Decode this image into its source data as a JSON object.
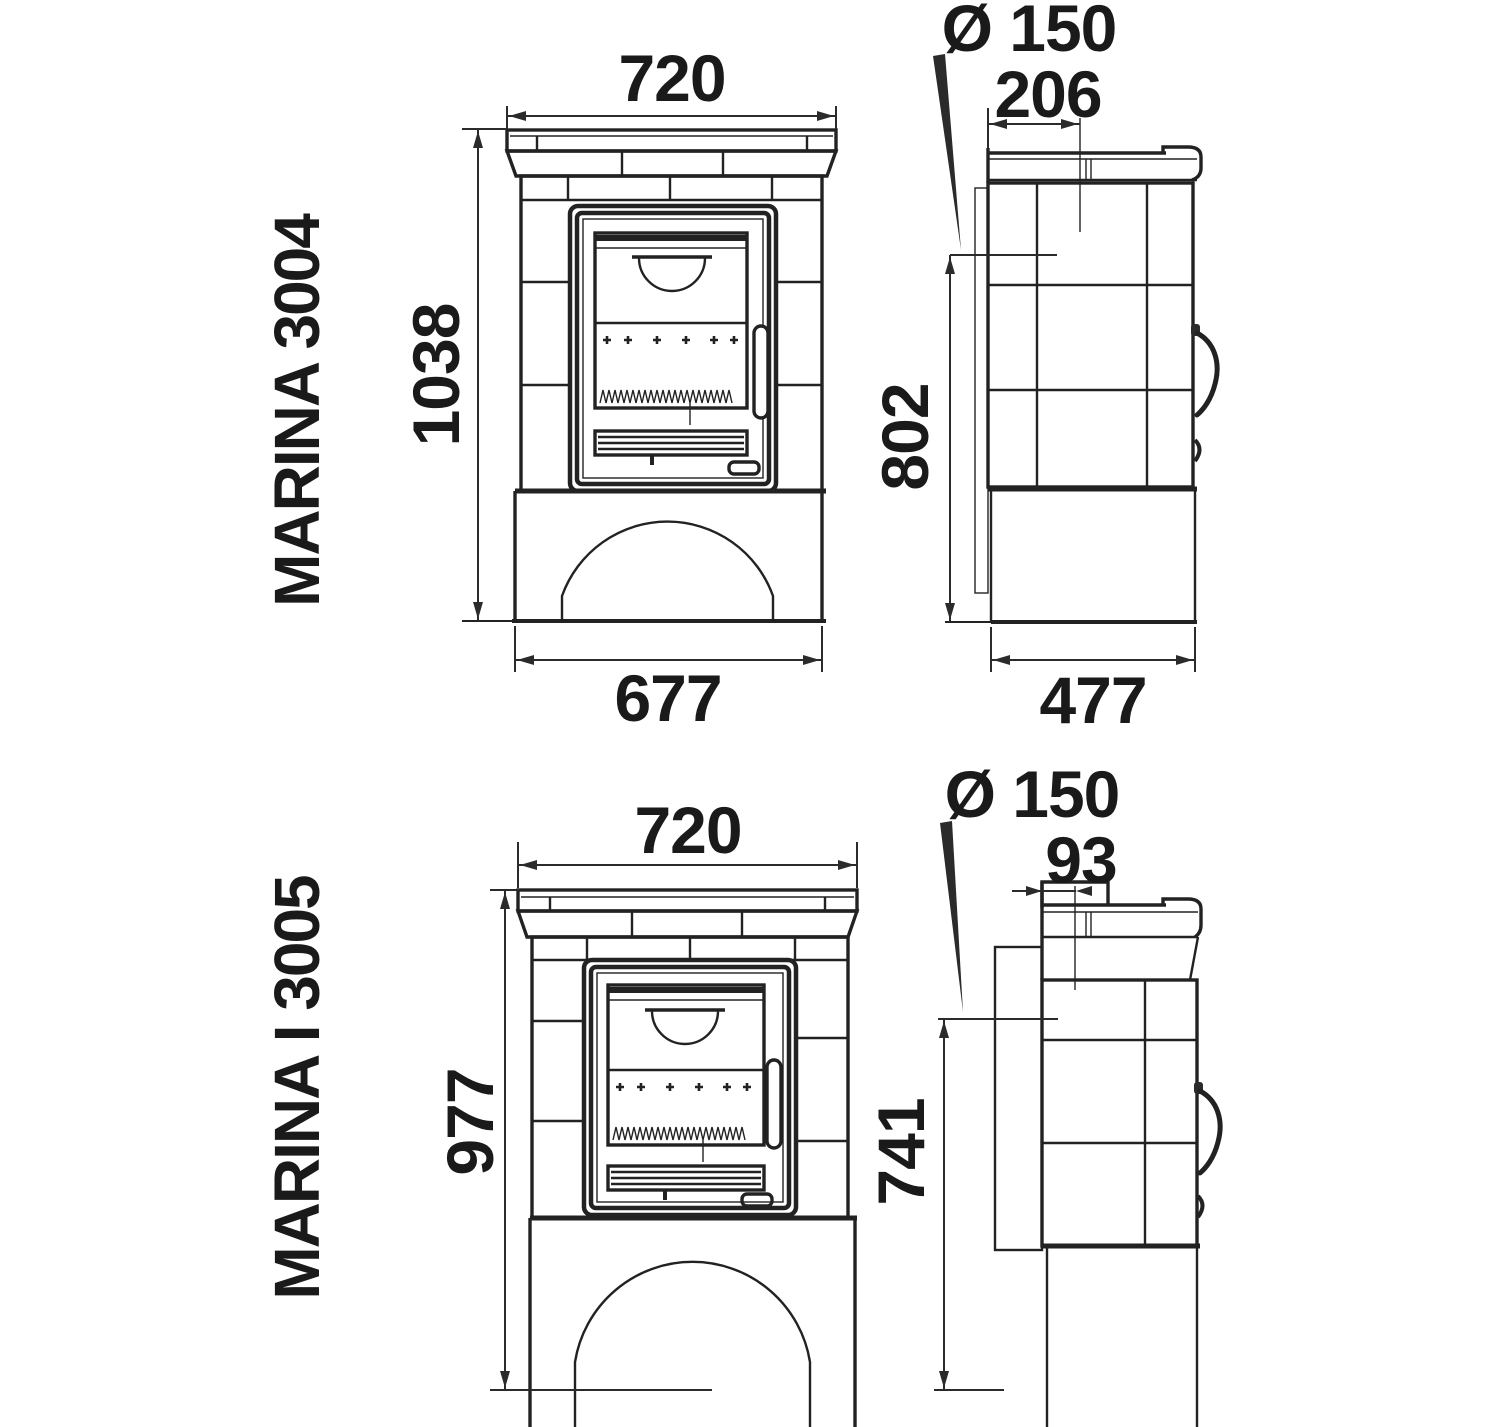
{
  "models": [
    {
      "name": "MARINA 3004",
      "front": {
        "width_top": "720",
        "height": "1038",
        "base_width": "677"
      },
      "side": {
        "flue_diameter": "Ø 150",
        "flue_offset": "206",
        "rear_height": "802",
        "depth": "477"
      }
    },
    {
      "name": "MARINA I 3005",
      "front": {
        "width_top": "720",
        "height": "977"
      },
      "side": {
        "flue_diameter": "Ø 150",
        "flue_offset": "93",
        "rear_height": "741"
      }
    }
  ],
  "colors": {
    "line": "#222222",
    "text": "#1a1a1a",
    "background": "#ffffff"
  }
}
